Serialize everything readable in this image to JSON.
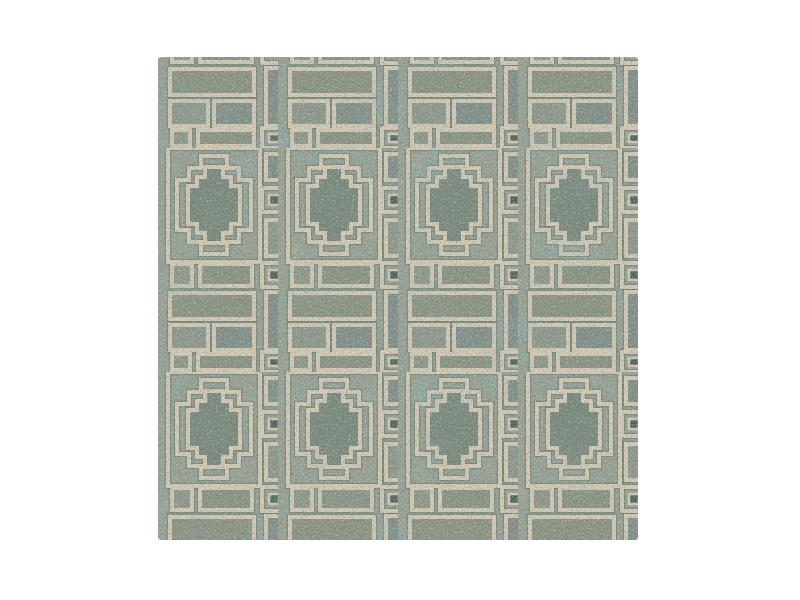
{
  "page": {
    "background_color": "#ffffff",
    "width": 800,
    "height": 600
  },
  "image": {
    "type": "product-photo",
    "subject": "Square hand-tufted wool rug swatch with geometric stepped-cross pattern on a white background",
    "pattern_style": "Greek-key lattice of framed stepped-cross (Aztec fret) medallions with square-in-square junction motifs and outlined bar fillers",
    "position": {
      "left": 158,
      "top": 57,
      "width": 480,
      "height": 483
    },
    "grid": {
      "medallion_columns": 4,
      "medallion_rows_visible": 2,
      "horizontal_repeat_px": 120,
      "vertical_repeat_px": 224,
      "frame_size_px": "92x114"
    },
    "colors": {
      "base_sage": "#98a296",
      "cream_line": "#d0c9b5",
      "medallion_fill": "#7b8a7f",
      "bar_fill_1": "#8b9584",
      "bar_fill_2": "#83918a",
      "bar_fill_3": "#90998c",
      "dark_teal_accent": "#54685e",
      "brown_accent": "#867b69",
      "shadow_line": "#5e6e64"
    },
    "texture": {
      "grain": "fine wool speckle, light and dark flecks",
      "variation": "large soft teal and warm-brown dye patches, faint horizontal weave striations"
    }
  }
}
